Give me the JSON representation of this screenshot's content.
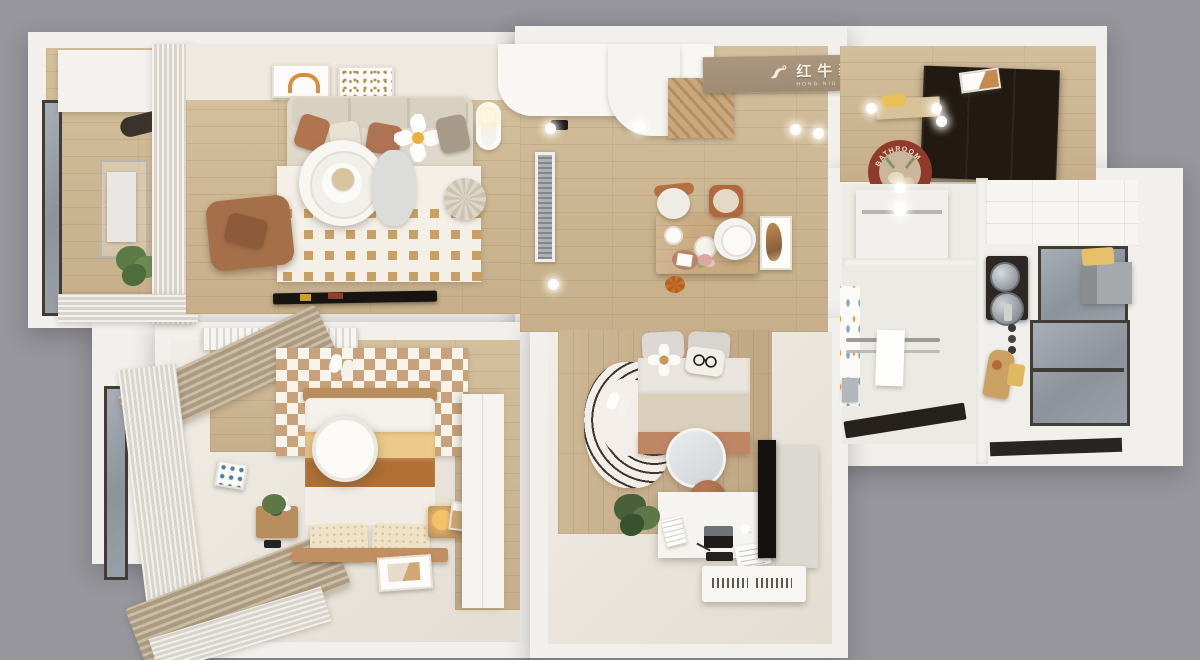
{
  "branding": {
    "logo_cn": "红牛装饰",
    "logo_en": "HONG NIU DECORATION"
  },
  "decor_text": {
    "bath_mat": "BATHROOM"
  },
  "palette": {
    "background": "#97969c",
    "outer_wall": "#f2f0ec",
    "wood_floor": "#cfb892",
    "cream_floor": "#ece7de",
    "rug_tan": "#c9a063",
    "sofa_beige": "#e0d9cb",
    "leather_brown": "#a56f49",
    "blanket_yellow": "#ecca8c",
    "blanket_caramel": "#b06f33",
    "bed2_terracotta": "#bf8666",
    "dark_wardrobe": "#221a12",
    "window_glass": "#9aa0a8",
    "mat_red": "#8f3b2c",
    "logo_band": "#a5917b"
  }
}
